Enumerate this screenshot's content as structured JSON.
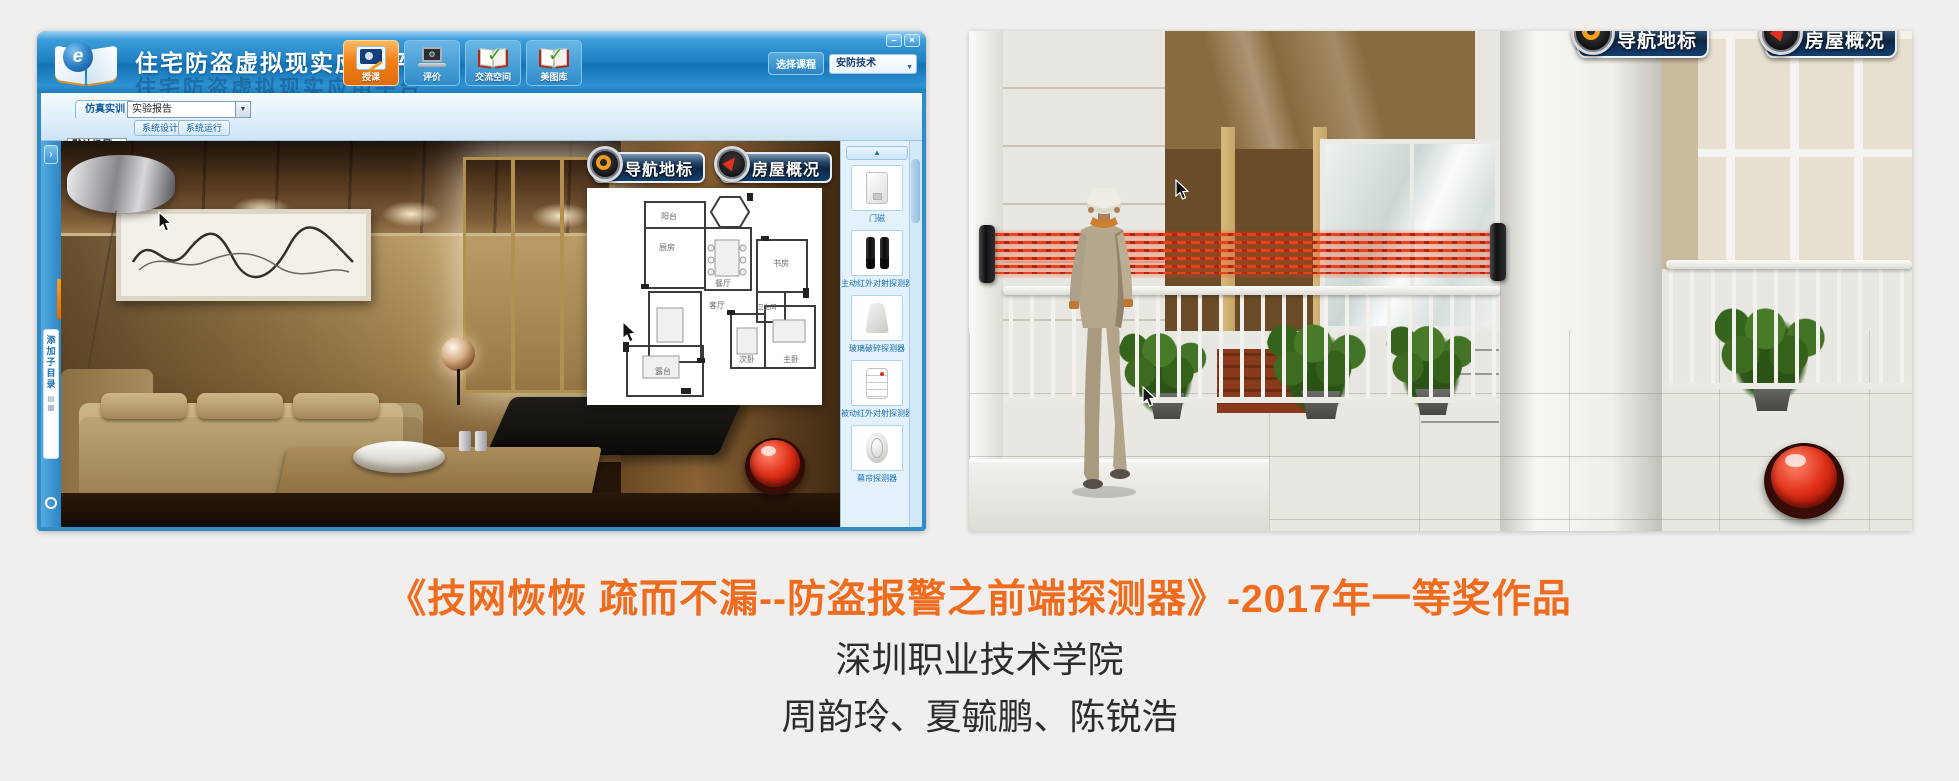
{
  "window": {
    "title": "住宅防盗虚拟现实应用平台",
    "controls": {
      "minimize": "–",
      "close": "×"
    },
    "toolbar": [
      {
        "label": "授课"
      },
      {
        "label": "评价"
      },
      {
        "label": "交流空间"
      },
      {
        "label": "美图库"
      }
    ],
    "course": {
      "label": "选择课程",
      "value": "安防技术"
    },
    "tabs": {
      "sim": "仿真实训",
      "report": "实验报告",
      "scene": "默认场景",
      "design": "系统设计",
      "run": "系统运行"
    },
    "rail": {
      "add_label": "添加子目录"
    },
    "overlay": {
      "nav": "导航地标",
      "overview": "房屋概况"
    },
    "devices": [
      "门磁",
      "主动红外对射探测器",
      "玻璃破碎探测器",
      "被动红外对射探测器",
      "幕帘探测器"
    ],
    "floorplan": {
      "rooms": [
        "阳台",
        "厨房",
        "餐厅",
        "书房",
        "卫生间",
        "客厅",
        "次卧",
        "主卧",
        "露台"
      ]
    }
  },
  "scene2": {
    "nav": "导航地标",
    "overview": "房屋概况"
  },
  "caption": {
    "line1": "《技网恢恢 疏而不漏--防盗报警之前端探测器》-2017年一等奖作品",
    "line2": "深圳职业技术学院",
    "line3": "周韵玲、夏毓鹏、陈锐浩",
    "title_color": "#ef6c1f"
  },
  "icons": {
    "scroll_up": "▲",
    "dropdown": "▼",
    "expander": "›"
  },
  "colors": {
    "titlebar_blue": "#1e81c2",
    "accent_orange": "#f08018",
    "beam_red": "#e2441f",
    "alarm_red": "#e03018",
    "label_blue": "#1a6eb4"
  }
}
